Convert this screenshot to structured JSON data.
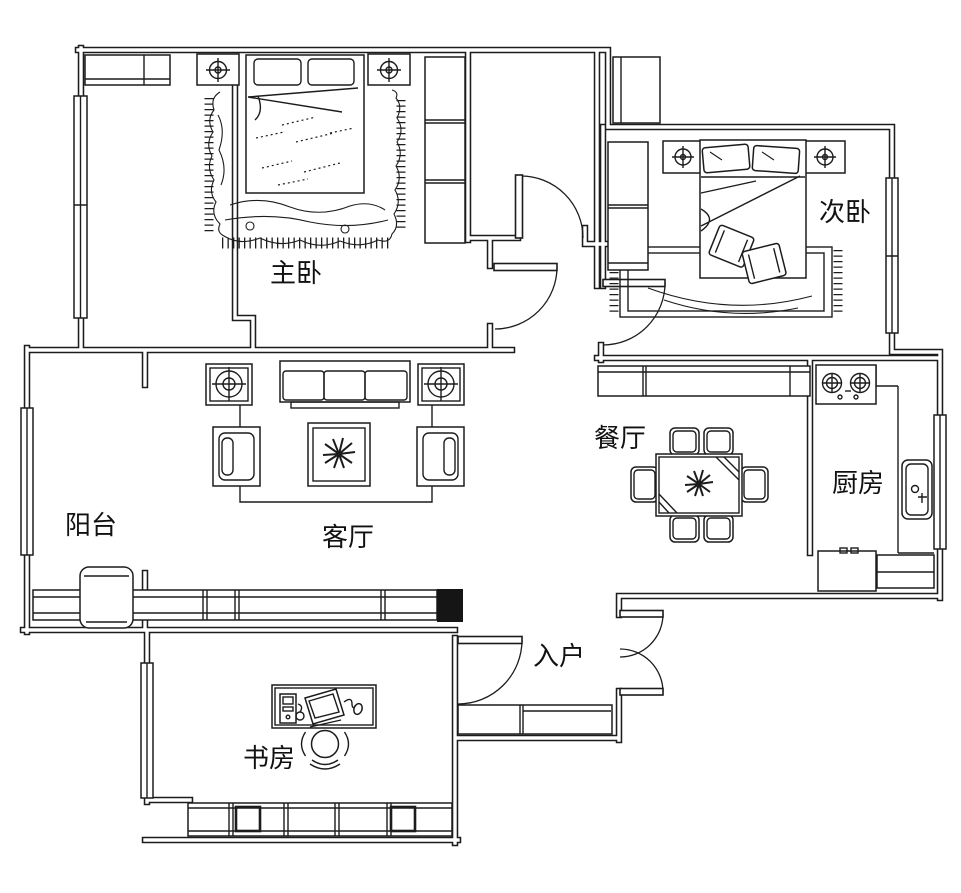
{
  "title": "apartment-floor-plan",
  "colors": {
    "line": "#1c1c1c",
    "background": "#ffffff",
    "column_fill": "#151515"
  },
  "rooms": [
    {
      "id": "master-bedroom",
      "label": "主卧"
    },
    {
      "id": "second-bedroom",
      "label": "次卧"
    },
    {
      "id": "living-room",
      "label": "客厅"
    },
    {
      "id": "balcony",
      "label": "阳台"
    },
    {
      "id": "dining-room",
      "label": "餐厅"
    },
    {
      "id": "kitchen",
      "label": "厨房"
    },
    {
      "id": "entry",
      "label": "入户"
    },
    {
      "id": "study",
      "label": "书房"
    }
  ]
}
